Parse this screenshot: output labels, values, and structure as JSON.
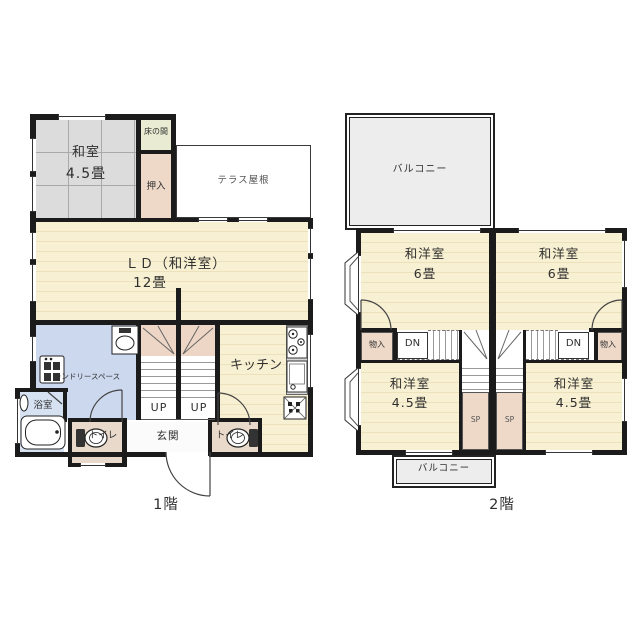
{
  "page": {
    "background": "#ffffff"
  },
  "colors": {
    "wall": "#1b1b1b",
    "tatami": "#dcdcdc",
    "wood_floor": "#f8f0d2",
    "water_area": "#ccd8ee",
    "bath": "#d6e1f2",
    "closet_pink": "#eed9c9",
    "tokonoma_green": "#e9ecd2",
    "toilet_floor": "#e9d9ca",
    "balcony_gray": "#ededed",
    "stair_winder_pink": "#edd6c6"
  },
  "floor1": {
    "label": "1階",
    "washitsu": {
      "name": "和室",
      "size": "4.5畳"
    },
    "tokonoma": "床の間",
    "oshiire": "押入",
    "terrace": "テラス屋根",
    "ld": {
      "name": "ＬＤ（和洋室）",
      "size": "12畳"
    },
    "laundry": "ランドリースペース",
    "bath": "浴室",
    "toilet_left": "トイレ",
    "toilet_right": "トイレ",
    "entrance": "玄関",
    "kitchen": "キッチン",
    "up_left": "UP",
    "up_right": "UP"
  },
  "floor2": {
    "label": "2階",
    "balcony_top": "バルコニー",
    "balcony_bottom": "バルコニー",
    "west6": {
      "name": "和洋室",
      "size": "6畳"
    },
    "east6": {
      "name": "和洋室",
      "size": "6畳"
    },
    "west45": {
      "name": "和洋室",
      "size": "4.5畳"
    },
    "east45": {
      "name": "和洋室",
      "size": "4.5畳"
    },
    "storage_left": "物入",
    "storage_right": "物入",
    "dn_left": "DN",
    "dn_right": "DN",
    "sp_left": "SP",
    "sp_right": "SP"
  }
}
